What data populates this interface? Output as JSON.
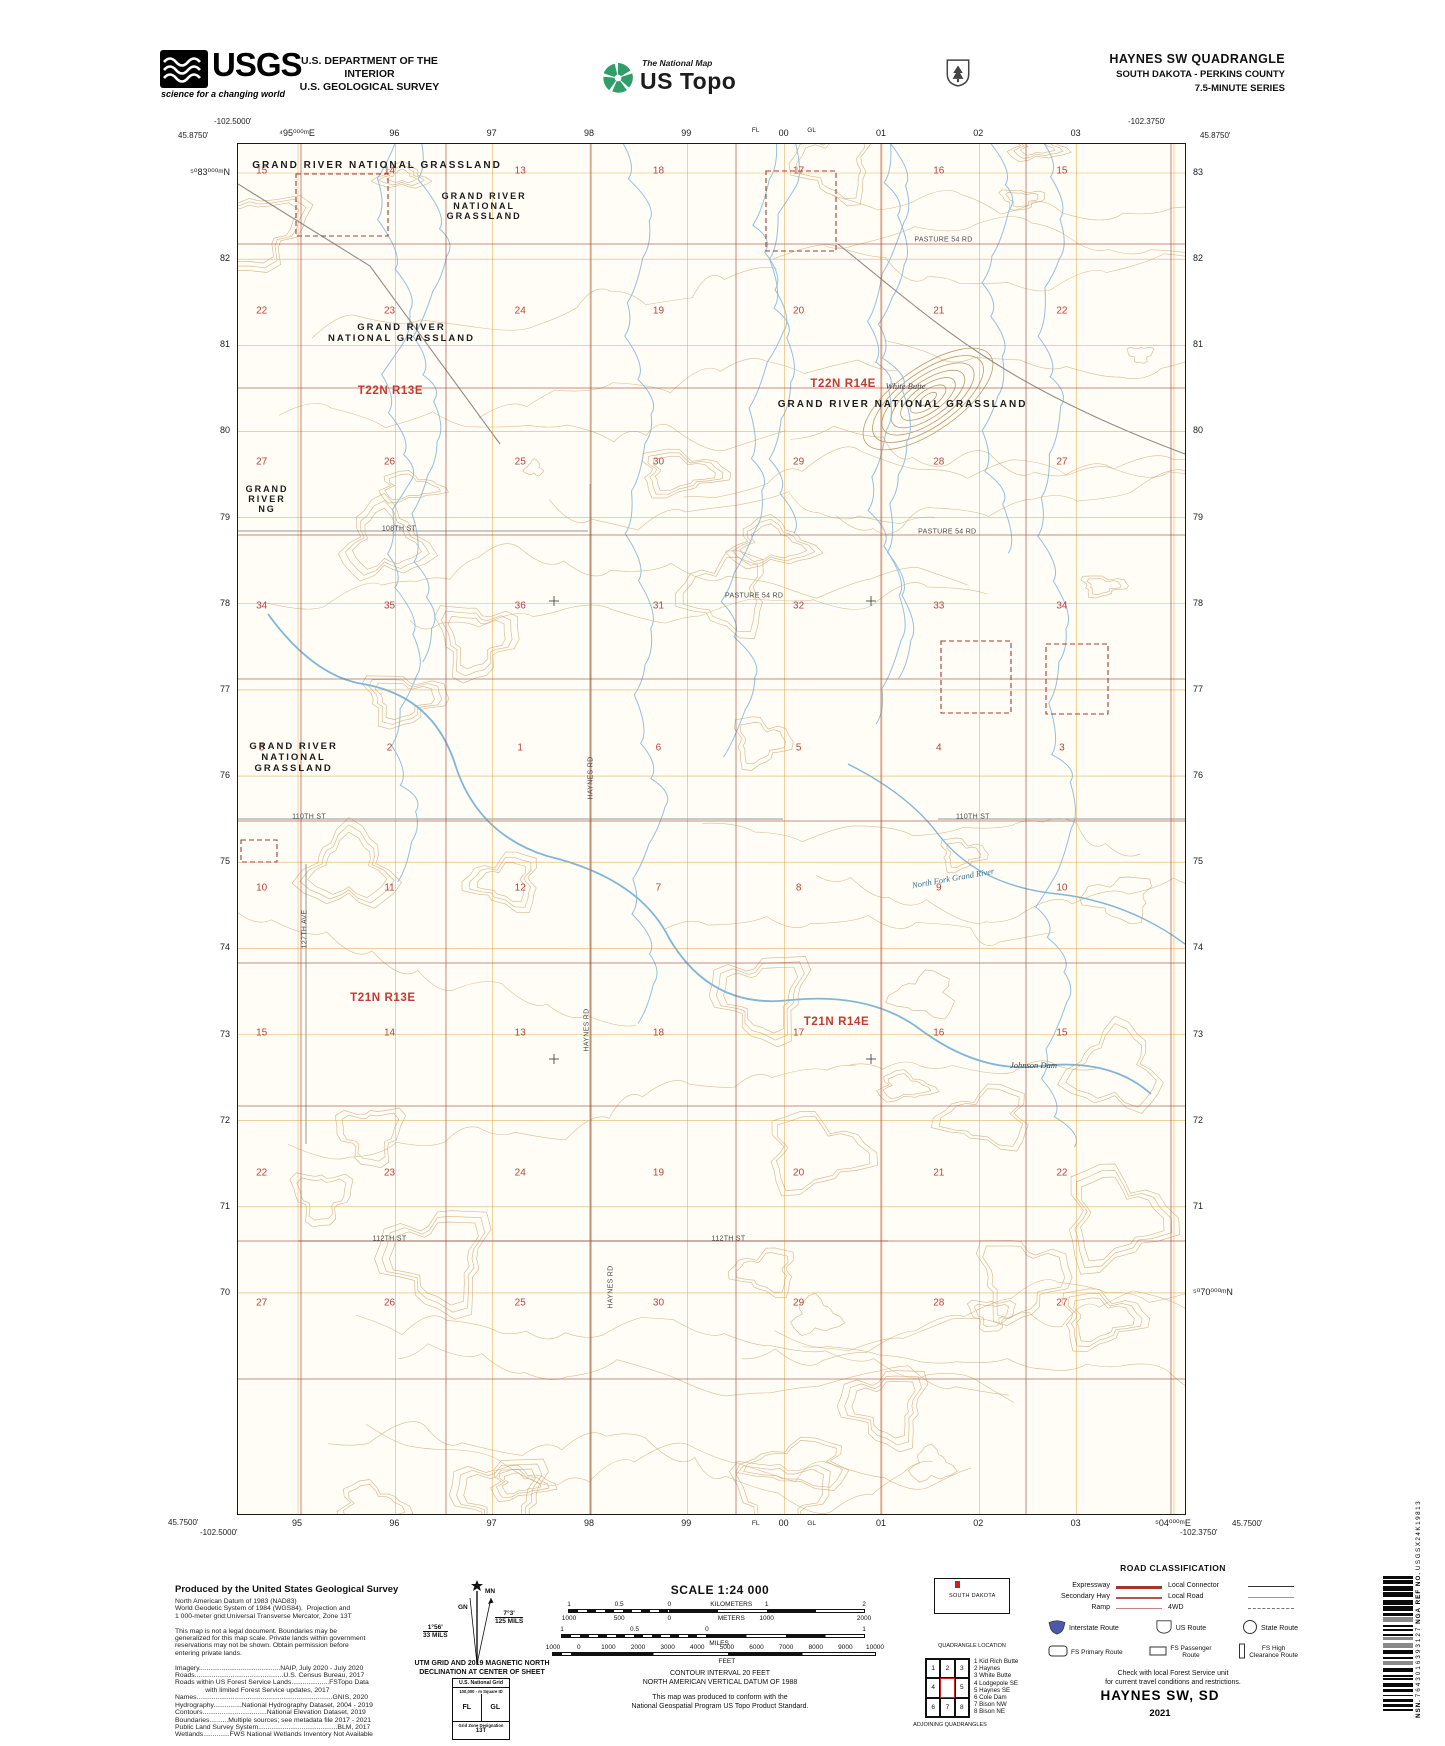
{
  "header": {
    "usgs": "USGS",
    "tagline": "science for a changing world",
    "dept1": "U.S. DEPARTMENT OF THE INTERIOR",
    "dept2": "U.S. GEOLOGICAL SURVEY",
    "tnm": "The National Map",
    "ustopo": "US Topo",
    "quad_title": "HAYNES SW QUADRANGLE",
    "quad_subtitle": "SOUTH DAKOTA - PERKINS COUNTY",
    "quad_series": "7.5-MINUTE SERIES"
  },
  "map": {
    "corners": {
      "tl_lon": "-102.5000'",
      "tl_lat": "45.8750'",
      "tr_lon": "-102.3750'",
      "tr_lat": "45.8750'",
      "bl_lat": "45.7500'",
      "bl_lon": "-102.5000'",
      "br_lon": "-102.3750'",
      "br_lat": "45.7500'"
    },
    "grid_top": [
      "⁴95⁰⁰⁰ᵐE",
      "96",
      "97",
      "98",
      "99",
      "00",
      "01",
      "02",
      "03"
    ],
    "grid_bottom": [
      "95",
      "96",
      "97",
      "98",
      "99",
      "00",
      "01",
      "02",
      "03",
      "⁵04⁰⁰⁰ᵐE"
    ],
    "grid_left": [
      "⁵⁰83⁰⁰⁰ᵐN",
      "82",
      "81",
      "80",
      "79",
      "78",
      "77",
      "76",
      "75",
      "74",
      "73",
      "72",
      "71",
      "70"
    ],
    "grid_right": [
      "83",
      "82",
      "81",
      "80",
      "79",
      "78",
      "77",
      "76",
      "75",
      "74",
      "73",
      "72",
      "71",
      "⁵⁰70⁰⁰⁰ᵐN"
    ],
    "square_ids": {
      "fl": "FL",
      "gl": "GL"
    },
    "township_labels": [
      {
        "text": "T22N R13E",
        "x": 16.1,
        "y": 18.0
      },
      {
        "text": "T22N R14E",
        "x": 63.9,
        "y": 17.5
      },
      {
        "text": "T21N R13E",
        "x": 15.3,
        "y": 62.3
      },
      {
        "text": "T21N R14E",
        "x": 63.2,
        "y": 64.1
      }
    ],
    "section_cols": [
      2.5,
      16.0,
      29.8,
      44.4,
      59.2,
      74.0,
      87.0
    ],
    "section_rows": [
      {
        "y": 2.0,
        "values": [
          "15",
          "14",
          "13",
          "18",
          "17",
          "16",
          "15"
        ]
      },
      {
        "y": 12.2,
        "values": [
          "22",
          "23",
          "24",
          "19",
          "20",
          "21",
          "22"
        ]
      },
      {
        "y": 23.2,
        "values": [
          "27",
          "26",
          "25",
          "30",
          "29",
          "28",
          "27"
        ]
      },
      {
        "y": 33.7,
        "values": [
          "34",
          "35",
          "36",
          "31",
          "32",
          "33",
          "34"
        ]
      },
      {
        "y": 44.1,
        "values": [
          "3",
          "2",
          "1",
          "6",
          "5",
          "4",
          "3"
        ]
      },
      {
        "y": 54.3,
        "values": [
          "10",
          "11",
          "12",
          "7",
          "8",
          "9",
          "10"
        ]
      },
      {
        "y": 64.9,
        "values": [
          "15",
          "14",
          "13",
          "18",
          "17",
          "16",
          "15"
        ]
      },
      {
        "y": 75.1,
        "values": [
          "22",
          "23",
          "24",
          "19",
          "20",
          "21",
          "22"
        ]
      },
      {
        "y": 84.6,
        "values": [
          "27",
          "26",
          "25",
          "30",
          "29",
          "28",
          "27"
        ]
      }
    ],
    "area_labels": [
      {
        "lines": [
          "GRAND RIVER NATIONAL GRASSLAND"
        ],
        "x": 1.5,
        "y": 1.2,
        "size": 10
      },
      {
        "lines": [
          "GRAND RIVER",
          "NATIONAL",
          "GRASSLAND"
        ],
        "x": 21.5,
        "y": 3.4,
        "size": 9
      },
      {
        "lines": [
          "GRAND RIVER",
          "NATIONAL GRASSLAND"
        ],
        "x": 9.5,
        "y": 13.0,
        "size": 9.5
      },
      {
        "lines": [
          "GRAND RIVER NATIONAL GRASSLAND"
        ],
        "x": 57.0,
        "y": 18.6,
        "size": 10
      },
      {
        "lines": [
          "GRAND",
          "RIVER",
          "NG"
        ],
        "x": 0.8,
        "y": 24.8,
        "size": 9
      },
      {
        "lines": [
          "GRAND RIVER",
          "NATIONAL",
          "GRASSLAND"
        ],
        "x": 1.2,
        "y": 43.6,
        "size": 9.5
      }
    ],
    "road_labels": [
      {
        "text": "PASTURE 54 RD",
        "x": 74.5,
        "y": 7.0,
        "rot": 0
      },
      {
        "text": "PASTURE 54 RD",
        "x": 74.9,
        "y": 28.3,
        "rot": 0
      },
      {
        "text": "PASTURE 54 RD",
        "x": 54.5,
        "y": 33.0,
        "rot": 0
      },
      {
        "text": "108TH ST",
        "x": 17.0,
        "y": 28.1,
        "rot": 0
      },
      {
        "text": "110TH ST",
        "x": 7.5,
        "y": 49.1,
        "rot": 0
      },
      {
        "text": "110TH ST",
        "x": 77.6,
        "y": 49.1,
        "rot": 0
      },
      {
        "text": "112TH ST",
        "x": 16.0,
        "y": 79.9,
        "rot": 0
      },
      {
        "text": "112TH ST",
        "x": 51.8,
        "y": 79.9,
        "rot": 0
      },
      {
        "text": "HAYNES RD",
        "x": 37.3,
        "y": 46.3,
        "rot": -90
      },
      {
        "text": "HAYNES RD",
        "x": 36.9,
        "y": 64.7,
        "rot": -90
      },
      {
        "text": "HAYNES RD",
        "x": 39.4,
        "y": 83.4,
        "rot": -90
      },
      {
        "text": "127TH AVE",
        "x": 7.1,
        "y": 57.3,
        "rot": -90
      }
    ],
    "feature_labels": [
      {
        "text": "White Butte",
        "x": 70.5,
        "y": 17.7,
        "rot": 0,
        "color": "#3d3d3d"
      },
      {
        "text": "North Fork Grand River",
        "x": 75.5,
        "y": 53.6,
        "rot": -10,
        "color": "#33708e"
      },
      {
        "text": "Johnson Dam",
        "x": 84.0,
        "y": 67.2,
        "rot": 0,
        "color": "#3d3d3d"
      }
    ]
  },
  "footer": {
    "produced_by": "Produced by the United States Geological Survey",
    "credits": [
      "North American Datum of 1983 (NAD83)",
      "World Geodetic System of 1984 (WGS84).  Projection and",
      "1 000-meter grid:Universal Transverse Mercator, Zone 13T",
      "",
      "This map is not a legal document. Boundaries may be",
      "generalized for this map scale. Private lands within government",
      "reservations may not be shown. Obtain permission before",
      "entering private lands.",
      "",
      "Imagery...........................................NAIP, July 2020 - July 2020",
      "Roads...............................................U.S. Census Bureau, 2017",
      "Roads within US Forest Service Lands....................FSTopo Data",
      "                with limited Forest Service updates, 2017",
      "Names........................................................................GNIS, 2020",
      "Hydrography...............National Hydrography Dataset, 2004 - 2019",
      "Contours..................................National Elevation Dataset, 2019",
      "Boundaries..........Multiple sources; see metadata file 2017 - 2021",
      "Public Land Survey System..........................................BLM, 2017",
      "Wetlands..............FWS National Wetlands Inventory Not Available"
    ],
    "decl": {
      "mn": "MN",
      "gn": "GN",
      "right_deg": "7°3'",
      "right_mils": "125 MILS",
      "left_deg": "1°56'",
      "left_mils": "33 MILS",
      "caption1": "UTM GRID AND 2019 MAGNETIC NORTH",
      "caption2": "DECLINATION AT CENTER OF SHEET"
    },
    "usng": {
      "title": "U.S. National Grid",
      "square_id_label": "100,000 - m Square ID",
      "cell_left": "FL",
      "cell_right": "GL",
      "zone_label": "Grid Zone Designation",
      "zone": "13T"
    },
    "scale_title": "SCALE 1:24 000",
    "scale_bars": [
      {
        "left": 568,
        "top": 1609,
        "width": 297,
        "zero": 34,
        "above": [
          {
            "t": "1",
            "p": 0
          },
          {
            "t": "0.5",
            "p": 17
          },
          {
            "t": "0",
            "p": 34
          },
          {
            "t": "KILOMETERS",
            "p": 55
          },
          {
            "t": "1",
            "p": 67
          },
          {
            "t": "2",
            "p": 100
          }
        ],
        "below": [
          {
            "t": "1000",
            "p": 0
          },
          {
            "t": "500",
            "p": 17
          },
          {
            "t": "0",
            "p": 34
          },
          {
            "t": "METERS",
            "p": 55
          },
          {
            "t": "1000",
            "p": 67
          },
          {
            "t": "2000",
            "p": 100
          }
        ]
      },
      {
        "left": 561,
        "top": 1634,
        "width": 304,
        "zero": 48,
        "above": [
          {
            "t": "1",
            "p": 0
          },
          {
            "t": "0.5",
            "p": 24
          },
          {
            "t": "0",
            "p": 48
          },
          {
            "t": "1",
            "p": 100
          }
        ],
        "below": [
          {
            "t": "MILES",
            "p": 52
          }
        ]
      },
      {
        "left": 552,
        "top": 1652,
        "width": 324,
        "zero": 8,
        "above": [
          {
            "t": "1000",
            "p": 0
          },
          {
            "t": "0",
            "p": 8
          },
          {
            "t": "1000",
            "p": 17.2
          },
          {
            "t": "2000",
            "p": 26.4
          },
          {
            "t": "3000",
            "p": 35.6
          },
          {
            "t": "4000",
            "p": 44.8
          },
          {
            "t": "5000",
            "p": 54
          },
          {
            "t": "6000",
            "p": 63.2
          },
          {
            "t": "7000",
            "p": 72.4
          },
          {
            "t": "8000",
            "p": 81.6
          },
          {
            "t": "9000",
            "p": 90.8
          },
          {
            "t": "10000",
            "p": 100
          }
        ],
        "below": [
          {
            "t": "FEET",
            "p": 54
          }
        ]
      }
    ],
    "contour1": "CONTOUR INTERVAL 20 FEET",
    "contour2": "NORTH AMERICAN VERTICAL DATUM OF 1988",
    "std1": "This map was produced to conform with the",
    "std2": "National Geospatial Program US Topo Product Standard.",
    "state": {
      "name": "SOUTH DAKOTA",
      "caption": "QUADRANGLE LOCATION"
    },
    "adjoining": {
      "cells": [
        "1",
        "2",
        "3",
        "4",
        "",
        "5",
        "6",
        "7",
        "8"
      ],
      "caption": "ADJOINING QUADRANGLES",
      "names": [
        "1 Kid Rich Butte",
        "2 Haynes",
        "3 White Butte",
        "4 Lodgepole SE",
        "5 Haynes SE",
        "6 Cole Dam",
        "7 Bison NW",
        "8 Bison NE"
      ]
    },
    "road_class": {
      "title": "ROAD CLASSIFICATION",
      "line_rows": [
        {
          "label1": "Expressway",
          "style1": "expressway",
          "label2": "Local Connector",
          "style2": "local-connector"
        },
        {
          "label1": "Secondary Hwy",
          "style1": "secondary",
          "label2": "Local Road",
          "style2": "local-road"
        },
        {
          "label1": "Ramp",
          "style1": "ramp",
          "label2": "4WD",
          "style2": "fourwd"
        }
      ],
      "shield_row": [
        {
          "icon": "interstate",
          "label": "Interstate Route"
        },
        {
          "icon": "us",
          "label": "US Route"
        },
        {
          "icon": "state",
          "label": "State Route"
        }
      ],
      "fs_row": [
        {
          "icon": "fs-primary",
          "label": "FS Primary Route"
        },
        {
          "icon": "fs-passenger",
          "label": "FS Passenger\nRoute"
        },
        {
          "icon": "fs-high",
          "label": "FS High\nClearance Route"
        }
      ],
      "note1": "Check with local Forest Service unit",
      "note2": "for current travel conditions and restrictions."
    },
    "map_title": "HAYNES SW,  SD",
    "year": "2021",
    "barcode": {
      "nsn_label": "NSN.",
      "nsn": "7643016393127",
      "nga_label": "NGA REF NO.",
      "nga": "USGSX24K19813"
    }
  }
}
